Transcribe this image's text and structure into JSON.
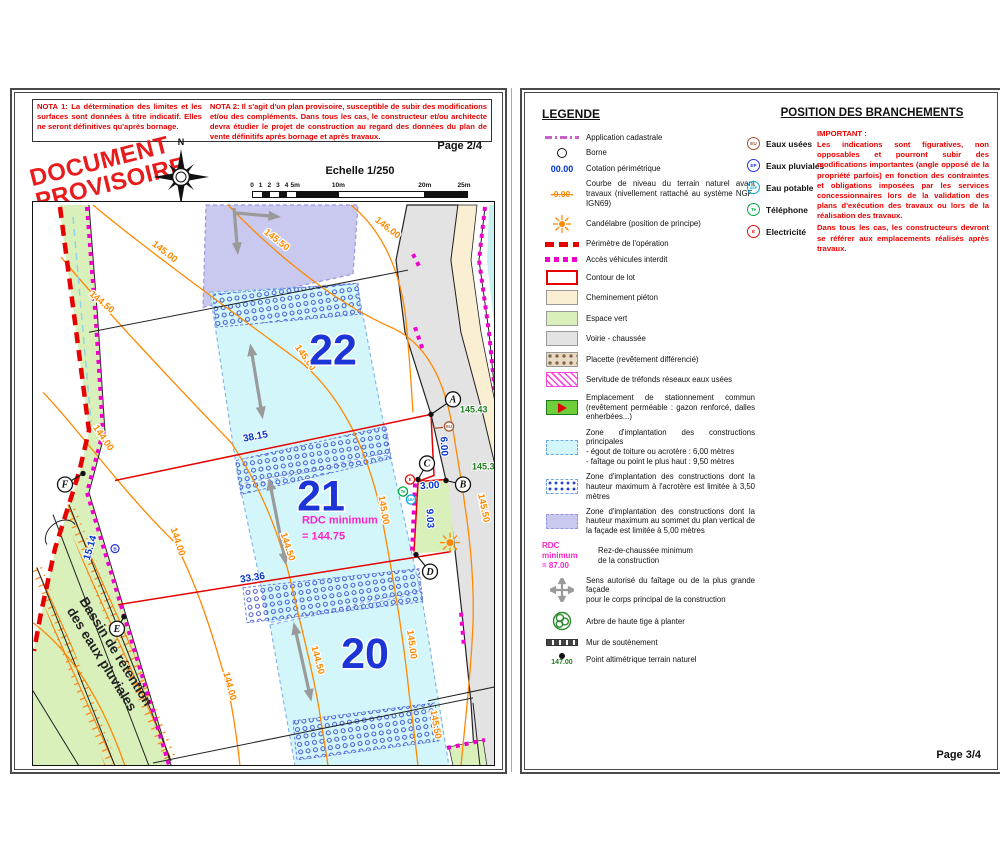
{
  "colors": {
    "perimeter_red": "#e60000",
    "access_magenta": "#ee00cc",
    "contour_orange": "#ff8800",
    "dimension_blue": "#0033cc",
    "lot_number_blue": "#1b35d6",
    "elevation_green": "#1e7d1e",
    "rdc_magenta": "#ff22cc"
  },
  "page_left": {
    "page_label": "Page 2/4",
    "stamp_line1": "DOCUMENT",
    "stamp_line2": "PROVISOIRE",
    "compass_label": "N",
    "nota1": "NOTA 1: La détermination des limites et les surfaces sont données à titre indicatif. Elles ne  seront définitives qu'après bornage.",
    "nota2": "NOTA 2: Il s'agit d'un plan provisoire, susceptible de subir des modifications et/ou des compléments. Dans tous les cas, le constructeur et/ou architecte devra étudier le projet de construction au regard des données du plan de vente définitifs après bornage et après travaux.",
    "scale": {
      "title": "Echelle 1/250",
      "ticks": [
        "0",
        "1",
        "2",
        "3",
        "4",
        "5m",
        "10m",
        "20m",
        "25m"
      ]
    },
    "map": {
      "basin_label": {
        "line1": "Bassin de rétention",
        "line2": "des eaux pluviales"
      },
      "rdc_note": {
        "line1": "RDC minimum",
        "line2": "= 144.75"
      },
      "lots": [
        {
          "n": "22",
          "x": 330,
          "y": 362
        },
        {
          "n": "21",
          "x": 318,
          "y": 508
        },
        {
          "n": "20",
          "x": 362,
          "y": 665
        }
      ],
      "contour_labels": [
        {
          "t": "146.00",
          "x": 383,
          "y": 228,
          "r": 38
        },
        {
          "t": "145.50",
          "x": 272,
          "y": 240,
          "r": 38
        },
        {
          "t": "145.50",
          "x": 478,
          "y": 506,
          "r": 78
        },
        {
          "t": "145.50",
          "x": 430,
          "y": 722,
          "r": 80
        },
        {
          "t": "145.00",
          "x": 160,
          "y": 252,
          "r": 38
        },
        {
          "t": "145.00",
          "x": 300,
          "y": 357,
          "r": 55
        },
        {
          "t": "145.00",
          "x": 378,
          "y": 508,
          "r": 80
        },
        {
          "t": "145.00",
          "x": 406,
          "y": 642,
          "r": 82
        },
        {
          "t": "144.50",
          "x": 97,
          "y": 302,
          "r": 40
        },
        {
          "t": "144.50",
          "x": 282,
          "y": 545,
          "r": 72
        },
        {
          "t": "144.50",
          "x": 312,
          "y": 658,
          "r": 75
        },
        {
          "t": "144.00",
          "x": 98,
          "y": 437,
          "r": 55
        },
        {
          "t": "144.00",
          "x": 172,
          "y": 540,
          "r": 72
        },
        {
          "t": "144.00",
          "x": 224,
          "y": 684,
          "r": 75
        }
      ],
      "dimensions": [
        {
          "t": "38.15",
          "x": 253,
          "y": 437,
          "r": -11
        },
        {
          "t": "33.36",
          "x": 250,
          "y": 578,
          "r": -9
        },
        {
          "t": "15.14",
          "x": 90,
          "y": 546,
          "r": -73
        },
        {
          "t": "6.00",
          "x": 438,
          "y": 444,
          "r": 87
        },
        {
          "t": "3.00",
          "x": 427,
          "y": 486,
          "r": -4
        },
        {
          "t": "9.03",
          "x": 424,
          "y": 516,
          "r": 87
        }
      ],
      "elevations": [
        {
          "t": "145.43",
          "x": 457,
          "y": 410
        },
        {
          "t": "145.37",
          "x": 469,
          "y": 467
        }
      ],
      "points": [
        {
          "l": "A",
          "x": 450,
          "y": 397,
          "dx": 428,
          "dy": 412
        },
        {
          "l": "B",
          "x": 460,
          "y": 482,
          "dx": 443,
          "dy": 478
        },
        {
          "l": "C",
          "x": 424,
          "y": 461,
          "dx": 415,
          "dy": 477
        },
        {
          "l": "D",
          "x": 427,
          "y": 569,
          "dx": 413,
          "dy": 552
        },
        {
          "l": "E",
          "x": 114,
          "y": 626,
          "dx": 121,
          "dy": 614
        },
        {
          "l": "F",
          "x": 62,
          "y": 482,
          "dx": 80,
          "dy": 471
        }
      ],
      "utilities": [
        {
          "c": "EU",
          "x": 446,
          "y": 424,
          "col": "#a0522d"
        },
        {
          "c": "E",
          "x": 407,
          "y": 477,
          "col": "#e01010"
        },
        {
          "c": "Te",
          "x": 400,
          "y": 489,
          "col": "#00aa44"
        },
        {
          "c": "AEP",
          "x": 408,
          "y": 497,
          "col": "#00aadd"
        }
      ],
      "bornes": [
        {
          "t": "B",
          "x": 112,
          "y": 546
        }
      ],
      "arrows": [
        {
          "x1": 249,
          "y1": 352,
          "x2": 258,
          "y2": 406,
          "h1": 1,
          "h2": 1
        },
        {
          "x1": 268,
          "y1": 486,
          "x2": 281,
          "y2": 552,
          "h1": 1,
          "h2": 1
        },
        {
          "x1": 293,
          "y1": 630,
          "x2": 306,
          "y2": 688,
          "h1": 1,
          "h2": 1
        },
        {
          "x1": 231,
          "y1": 206,
          "x2": 234,
          "y2": 242,
          "h1": 0,
          "h2": 1
        },
        {
          "x1": 233,
          "y1": 211,
          "x2": 267,
          "y2": 214,
          "h1": 0,
          "h2": 1
        }
      ]
    }
  },
  "page_right": {
    "page_label": "Page 3/4",
    "legend_title": "LEGENDE",
    "legend_items": [
      {
        "label": "Application cadastrale"
      },
      {
        "label": "Borne"
      },
      {
        "label": "Cotation périmétrique",
        "swatch_text": "00.00"
      },
      {
        "label": "Courbe de niveau du terrain naturel avant travaux (nivellement rattaché au système NGF-IGN69)",
        "swatch_text": "-0.00-"
      },
      {
        "label": "Candélabre (position de principe)"
      },
      {
        "label": "Périmètre de l'opération"
      },
      {
        "label": "Accès véhicules interdit"
      },
      {
        "label": "Contour de lot"
      },
      {
        "label": "Cheminement piéton"
      },
      {
        "label": "Espace vert"
      },
      {
        "label": "Voirie - chaussée"
      },
      {
        "label": "Placette (revêtement différencié)"
      },
      {
        "label": "Servitude de tréfonds réseaux eaux usées"
      },
      {
        "label": "Emplacement de stationnement commun (revêtement perméable : gazon renforcé, dalles enherbées...)"
      },
      {
        "label": "Zone d'implantation des constructions principales\n- égout de toiture ou acrotère : 6,00 mètres\n- faîtage ou point le plus haut : 9,50 mètres"
      },
      {
        "label": "Zone d'implantation des constructions dont la hauteur maximum à l'acrotère est limitée à 3,50 mètres"
      },
      {
        "label": "Zone d'implantation des constructions dont la hauteur maximum au sommet du  plan vertical de la façade est limitée à 5,00 mètres"
      },
      {
        "label": "Rez-de-chaussée minimum\nde la construction",
        "swatch_text": "RDC minimum\n= 87.00"
      },
      {
        "label": "Sens autorisé du faîtage ou de la plus grande façade\npour le corps principal de la construction"
      },
      {
        "label": "Arbre de haute tige à planter"
      },
      {
        "label": "Mur de soutènement"
      },
      {
        "label": "Point altimétrique terrain naturel",
        "swatch_text": "147.00"
      }
    ],
    "branchements_title": "POSITION DES BRANCHEMENTS",
    "branchements": [
      {
        "code": "EU",
        "label": "Eaux usées",
        "color": "#a0522d"
      },
      {
        "code": "EP",
        "label": "Eaux pluviales",
        "color": "#2233ee"
      },
      {
        "code": "AEP",
        "label": "Eau potable",
        "color": "#00aadd"
      },
      {
        "code": "Te",
        "label": "Téléphone",
        "color": "#00aa44"
      },
      {
        "code": "E",
        "label": "Electricité",
        "color": "#e01010"
      }
    ],
    "important_title": "IMPORTANT :",
    "important_p1": "Les indications sont figuratives, non opposables et pourront subir des modifications importantes (angle opposé de la propriété parfois) en fonction des contraintes et obligations imposées par les services concessionnaires lors de la validation des plans d'exécution des travaux ou lors de la réalisation des travaux.",
    "important_p2": "Dans tous les cas, les constructeurs devront se référer aux emplacements réalisés après travaux."
  }
}
